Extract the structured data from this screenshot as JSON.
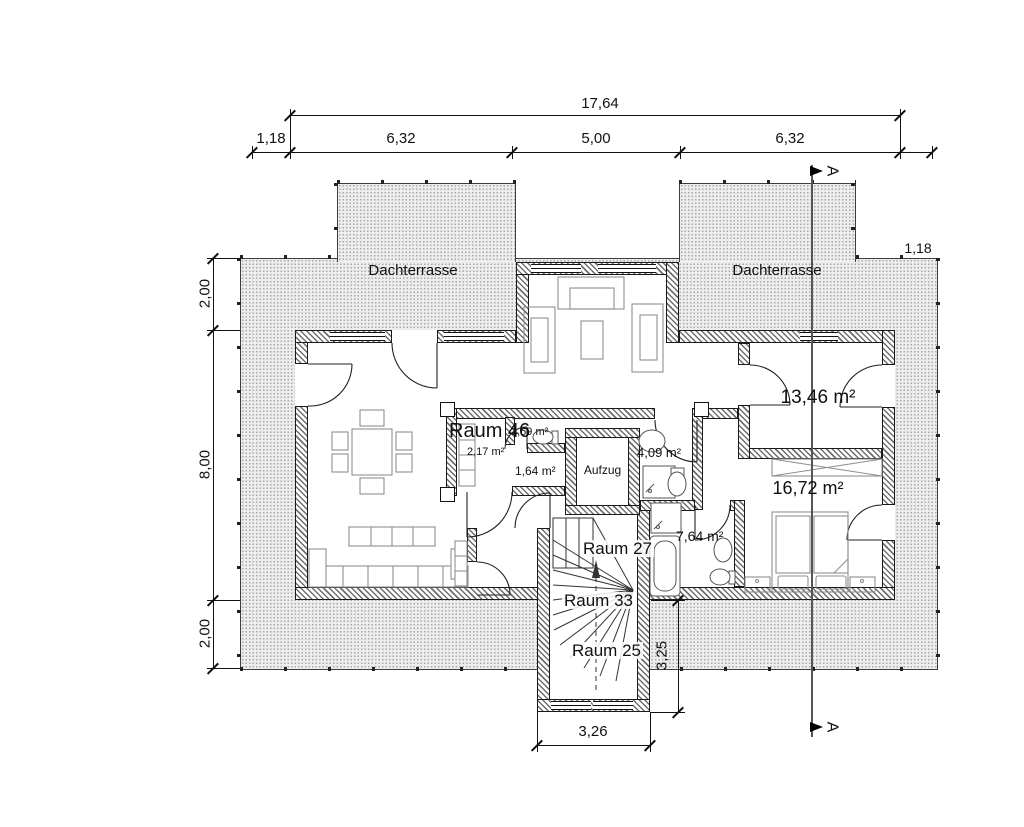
{
  "drawing": {
    "type": "floor-plan-upper-storey",
    "dims": {
      "total": "17,64",
      "top": [
        "1,18",
        "6,32",
        "5,00",
        "6,32"
      ],
      "left": [
        "2,00",
        "8,00",
        "2,00"
      ],
      "right_strip": "1,18",
      "stair_w": "3,26",
      "stair_d": "3,25"
    },
    "labels": {
      "terrace_left": "Dachterrasse",
      "terrace_right": "Dachterrasse",
      "raum46": "Raum 46",
      "a159": "1,59 m²",
      "a217": "2,17 m²",
      "a164": "1,64 m²",
      "elevator": "Aufzug",
      "a409": "4,09 m²",
      "a1346": "13,46 m²",
      "a1672": "16,72 m²",
      "a764": "7,64 m²",
      "raum27": "Raum 27",
      "raum33": "Raum 33",
      "raum25": "Raum 25"
    },
    "section": {
      "marker": "A"
    },
    "colors": {
      "line": "#1a1a1a",
      "wall_hatch": "#6f6f6f",
      "terrace_fill": "#ededed",
      "terrace_dot": "#a9a9a9",
      "furniture": "#8f8f8f"
    }
  }
}
